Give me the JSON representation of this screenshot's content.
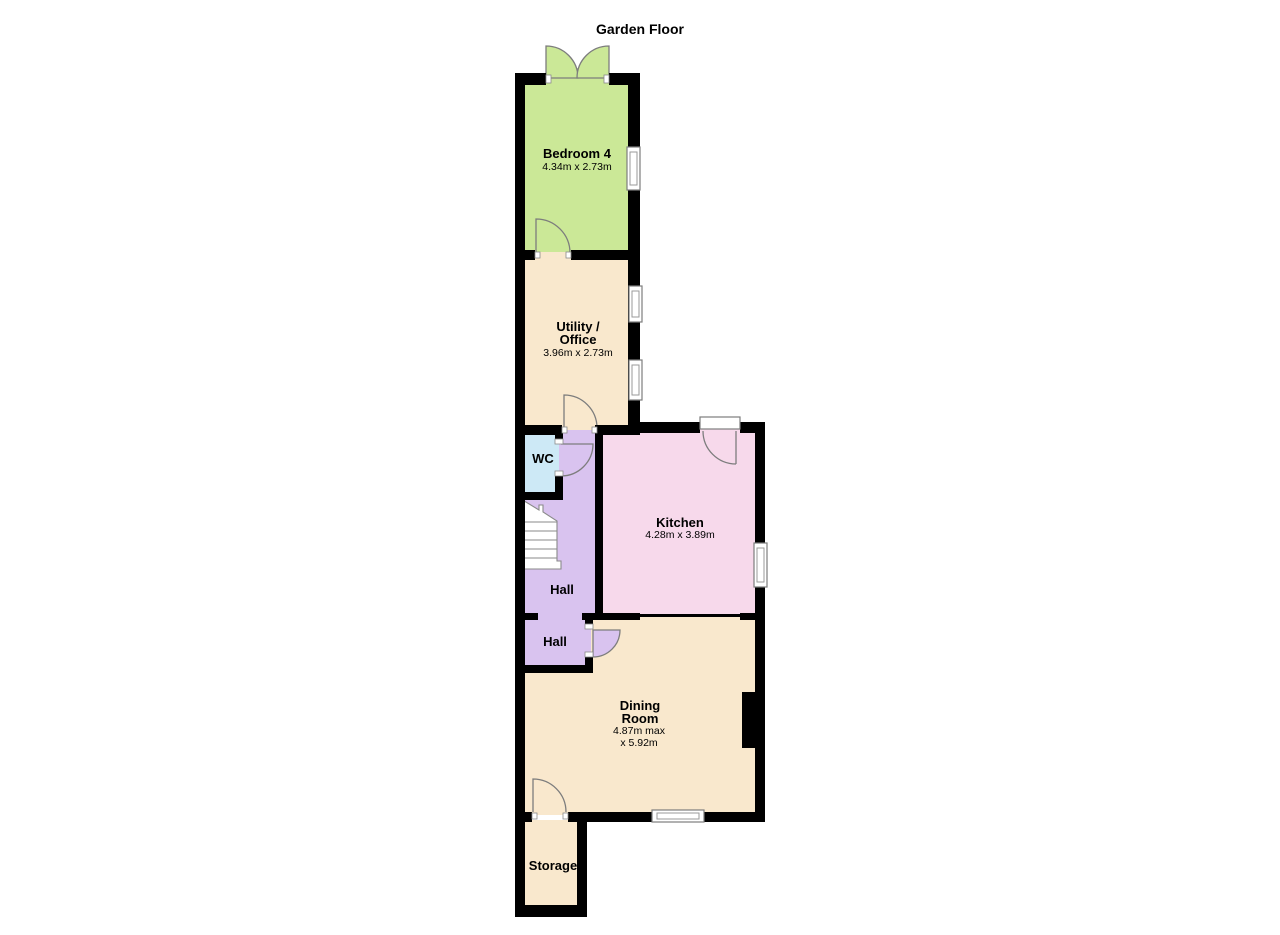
{
  "title": "Garden Floor",
  "colors": {
    "bedroom": "#cbe897",
    "cream": "#f9e8cd",
    "kitchen": "#f7d9eb",
    "hall": "#d9c3ef",
    "wc": "#cde9f6",
    "wall": "#000000"
  },
  "rooms": {
    "bedroom4": {
      "name": "Bedroom 4",
      "dims": "4.34m x 2.73m"
    },
    "utility": {
      "name_line1": "Utility /",
      "name_line2": "Office",
      "dims": "3.96m x 2.73m"
    },
    "wc": {
      "name": "WC"
    },
    "hall1": {
      "name": "Hall"
    },
    "kitchen": {
      "name": "Kitchen",
      "dims": "4.28m x 3.89m"
    },
    "hall2": {
      "name": "Hall"
    },
    "dining": {
      "name_line1": "Dining",
      "name_line2": "Room",
      "dims_line1": "4.87m max",
      "dims_line2": "x 5.92m"
    },
    "storage": {
      "name": "Storage"
    }
  }
}
